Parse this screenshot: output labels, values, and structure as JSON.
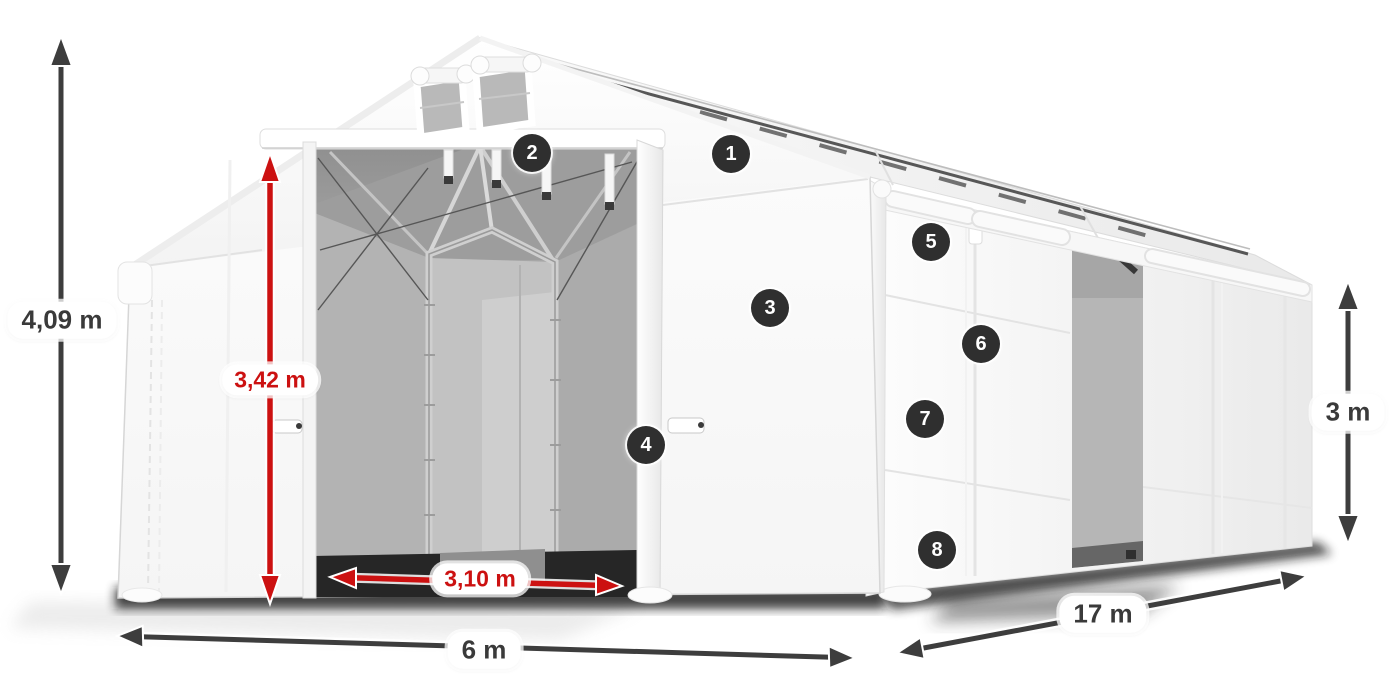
{
  "diagram": {
    "subject": "white-storage-tent-dimension-diagram",
    "dimensions": {
      "total_height": "4,09 m",
      "inner_height": "3,42 m",
      "entrance_width": "3,10 m",
      "width": "6 m",
      "length": "17 m",
      "side_height": "3 m"
    },
    "callouts": [
      "1",
      "2",
      "3",
      "4",
      "5",
      "6",
      "7",
      "8"
    ],
    "colors": {
      "dimension_primary": "#3d3d3d",
      "dimension_accent": "#cc1111",
      "badge_background": "#2f2f2f",
      "tent_white": "#ffffff",
      "interior_gray": "#a8a8a8"
    }
  }
}
